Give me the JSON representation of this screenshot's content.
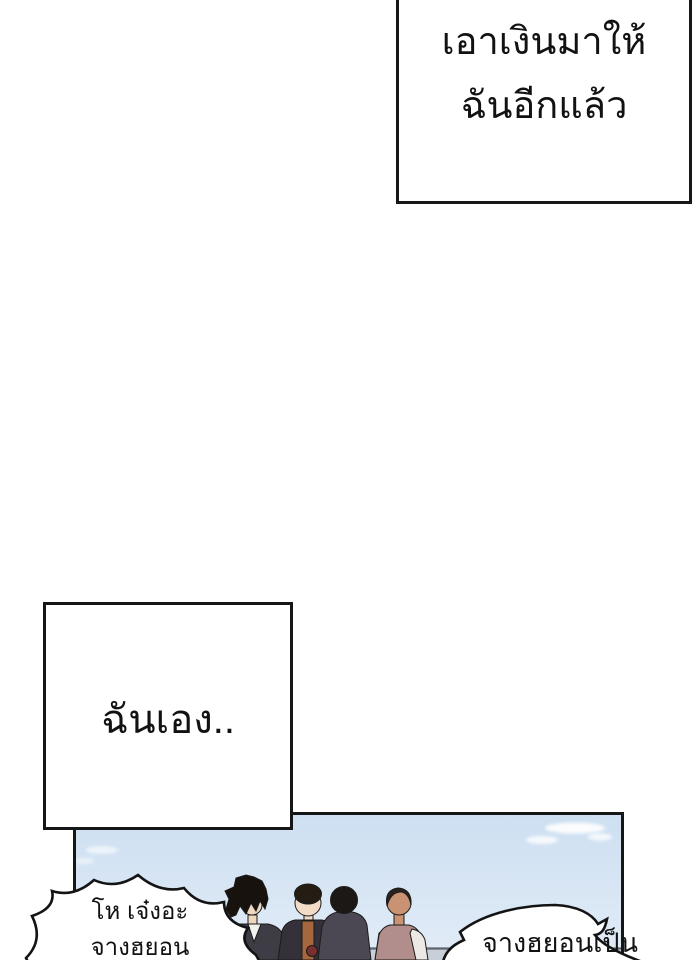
{
  "comic": {
    "ink_color": "#161616",
    "paper_color": "#ffffff",
    "narration_boxes": [
      {
        "name": "top-right",
        "lines": [
          "เอาเงินมาให้",
          "ฉันอีกแล้ว"
        ]
      },
      {
        "name": "middle-left",
        "lines": [
          "ฉันเอง.."
        ]
      }
    ],
    "speech_bubbles": [
      {
        "name": "left-burst",
        "shape": "burst",
        "lines": [
          "โห เจ๋งอะ",
          "จางฮยอน"
        ]
      },
      {
        "name": "right-cloud",
        "shape": "cloud",
        "lines": [
          "จางฮยอนเป็น"
        ]
      }
    ],
    "scene": {
      "description_colors": {
        "sky_top": "#cddff1",
        "sky_bottom": "#e2ecf7",
        "cloud": "#ffffff",
        "railing": "#c9cfd8",
        "railing_edge": "#5d6472"
      },
      "characters": [
        {
          "name": "spiky-hair-boy",
          "hair": "#17120e",
          "skin": "#eed6bf",
          "jacket": "#3e3c44",
          "shirt": "#f3f1ed"
        },
        {
          "name": "bowl-hair-boy",
          "hair": "#251d14",
          "skin": "#f2dcc6",
          "coat": "#34313a",
          "shirt": "#a4673e",
          "item": "#7a2f2f"
        },
        {
          "name": "back-facing-man",
          "hair": "#1c1815",
          "coat": "#4b4853"
        },
        {
          "name": "mauve-shirt-man",
          "hair": "#2a231e",
          "skin": "#c99272",
          "tee": "#b18e8b",
          "sleeve": "#ece9e4"
        }
      ]
    }
  }
}
